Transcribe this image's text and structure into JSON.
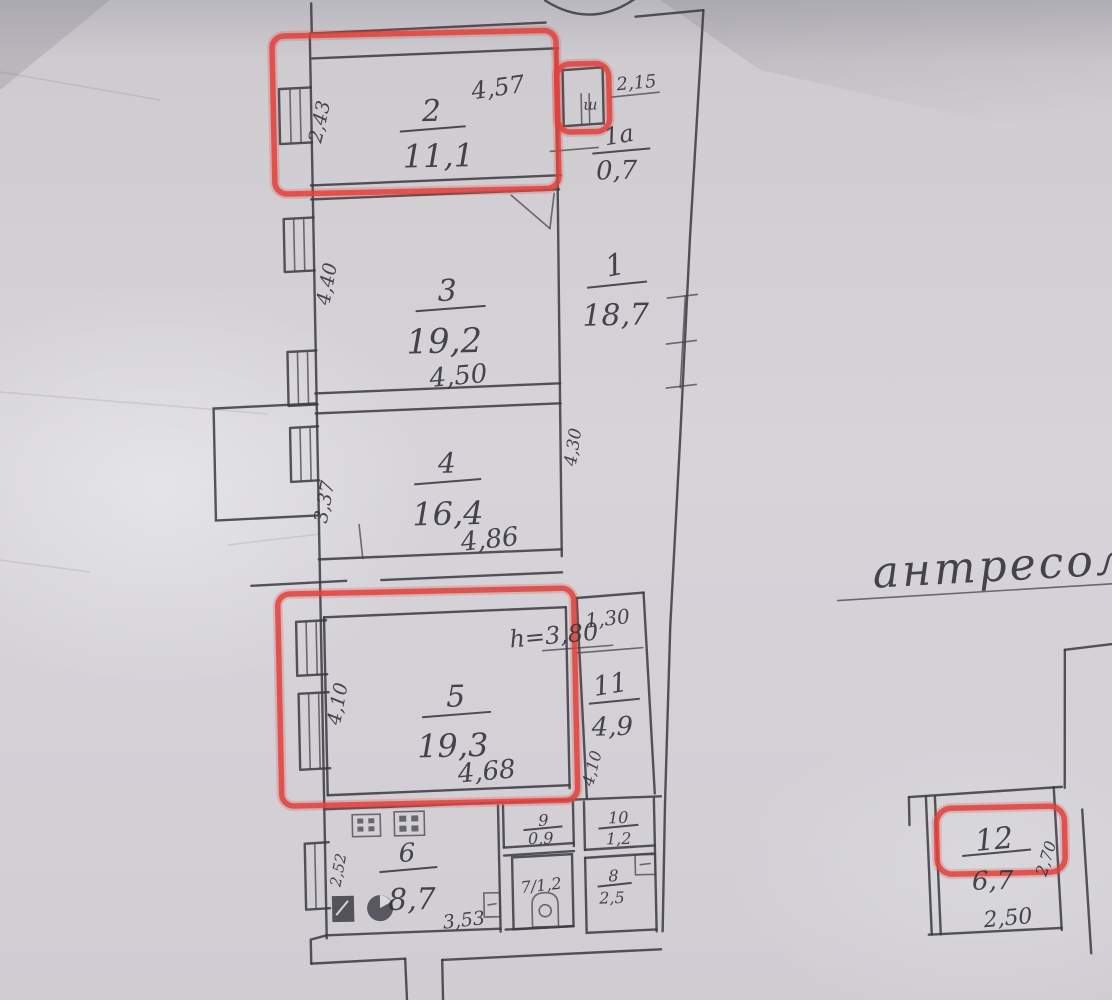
{
  "plan": {
    "mezzanine_title": "антресоль",
    "rooms": {
      "r1": {
        "number": "1",
        "area": "18,7",
        "side_dim": "4,30"
      },
      "r1a": {
        "number": "1а",
        "area": "0,7"
      },
      "r2": {
        "number": "2",
        "area": "11,1",
        "top_dim": "4,57",
        "side_dim": "2,43"
      },
      "r3": {
        "number": "3",
        "area": "19,2",
        "bottom_dim": "4,50",
        "side_dim": "4,40"
      },
      "r4": {
        "number": "4",
        "area": "16,4",
        "bottom_dim": "4,86",
        "side_dim": "3,37"
      },
      "r5": {
        "number": "5",
        "area": "19,3",
        "bottom_dim": "4,68",
        "side_dim": "4,10",
        "height_note": "h=3,80"
      },
      "r6": {
        "number": "6",
        "area": "8,7",
        "bottom_dim": "3,53",
        "side_dim": "2,52"
      },
      "r7": {
        "label": "7/1,2"
      },
      "r8": {
        "number": "8",
        "area": "2,5"
      },
      "r9": {
        "number": "9",
        "area": "0,9"
      },
      "r10": {
        "number": "10",
        "area": "1,2"
      },
      "r11": {
        "number": "11",
        "area": "4,9",
        "top_dim": "1,30",
        "side_dim": "4,10"
      },
      "r12": {
        "number": "12",
        "area": "6,7",
        "bottom_dim": "2,50",
        "side_dim": "2,70"
      }
    },
    "annotations": {
      "closet_dim": "2,15",
      "closet_mark": "ш"
    },
    "colors": {
      "highlight": "#e0423d",
      "ink": "#3b3940",
      "paper": "#d3d1d6"
    }
  }
}
